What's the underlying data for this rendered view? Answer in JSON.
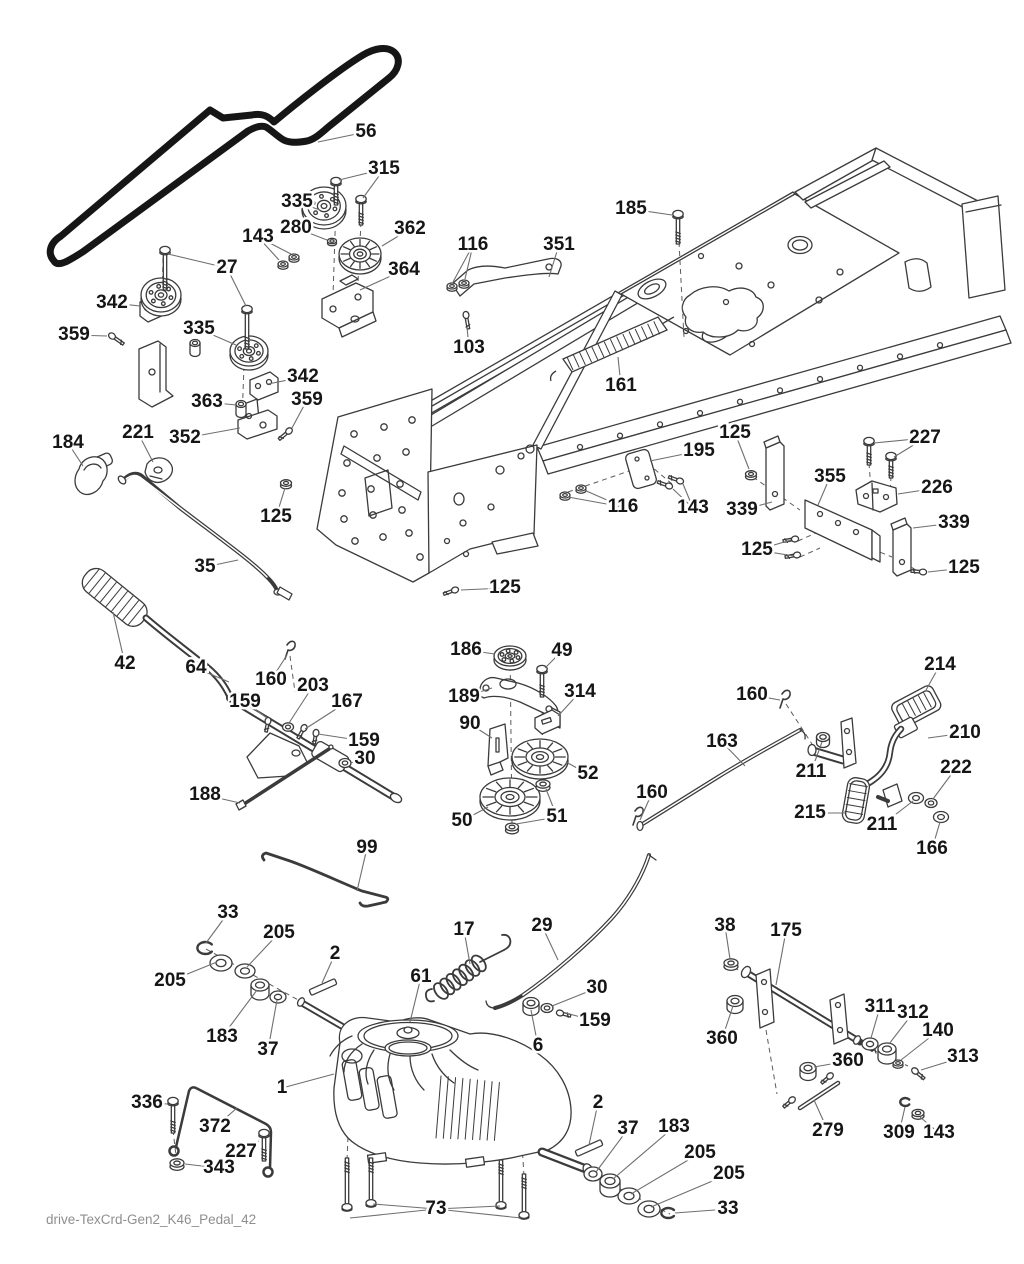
{
  "footer": "drive-TexCrd-Gen2_K46_Pedal_42",
  "colors": {
    "line": "#3b3b3b",
    "belt": "#161616",
    "leader": "#6f6f6f",
    "label_text": "#161616",
    "footer_text": "#8f8f8f",
    "background": "#ffffff"
  },
  "diagram": {
    "type": "exploded-parts-diagram",
    "labels": [
      {
        "text": "56",
        "x": 366,
        "y": 132,
        "leaders": [
          [
            318,
            142
          ]
        ]
      },
      {
        "text": "315",
        "x": 384,
        "y": 169,
        "leaders": [
          [
            339,
            180
          ],
          [
            363,
            198
          ]
        ]
      },
      {
        "text": "335",
        "x": 297,
        "y": 202,
        "leaders": [
          [
            320,
            210
          ]
        ]
      },
      {
        "text": "280",
        "x": 296,
        "y": 228,
        "leaders": [
          [
            327,
            240
          ]
        ]
      },
      {
        "text": "362",
        "x": 410,
        "y": 229,
        "leaders": [
          [
            382,
            246
          ]
        ]
      },
      {
        "text": "143",
        "x": 258,
        "y": 237,
        "leaders": [
          [
            279,
            260
          ],
          [
            291,
            254
          ]
        ]
      },
      {
        "text": "364",
        "x": 404,
        "y": 270,
        "leaders": [
          [
            360,
            290
          ]
        ]
      },
      {
        "text": "27",
        "x": 227,
        "y": 268,
        "leaders": [
          [
            168,
            254
          ],
          [
            246,
            306
          ]
        ]
      },
      {
        "text": "342",
        "x": 112,
        "y": 303,
        "leaders": [
          [
            140,
            306
          ]
        ]
      },
      {
        "text": "335",
        "x": 199,
        "y": 329,
        "leaders": [
          [
            236,
            345
          ]
        ]
      },
      {
        "text": "359",
        "x": 74,
        "y": 335,
        "leaders": [
          [
            107,
            336
          ]
        ]
      },
      {
        "text": "116",
        "x": 473,
        "y": 245,
        "leaders": [
          [
            453,
            282
          ],
          [
            465,
            279
          ]
        ]
      },
      {
        "text": "103",
        "x": 469,
        "y": 348,
        "leaders": [
          [
            467,
            327
          ]
        ]
      },
      {
        "text": "342",
        "x": 303,
        "y": 377,
        "leaders": [
          [
            268,
            384
          ]
        ]
      },
      {
        "text": "363",
        "x": 207,
        "y": 402,
        "leaders": [
          [
            236,
            405
          ]
        ]
      },
      {
        "text": "359",
        "x": 307,
        "y": 400,
        "leaders": [
          [
            292,
            428
          ]
        ]
      },
      {
        "text": "352",
        "x": 185,
        "y": 438,
        "leaders": [
          [
            240,
            428
          ]
        ]
      },
      {
        "text": "184",
        "x": 68,
        "y": 443,
        "leaders": [
          [
            83,
            466
          ]
        ]
      },
      {
        "text": "221",
        "x": 138,
        "y": 433,
        "leaders": [
          [
            153,
            462
          ]
        ]
      },
      {
        "text": "125",
        "x": 276,
        "y": 517,
        "leaders": [
          [
            285,
            488
          ]
        ]
      },
      {
        "text": "35",
        "x": 205,
        "y": 567,
        "leaders": [
          [
            238,
            560
          ]
        ]
      },
      {
        "text": "42",
        "x": 125,
        "y": 664,
        "leaders": [
          [
            113,
            612
          ]
        ]
      },
      {
        "text": "64",
        "x": 196,
        "y": 668,
        "leaders": [
          [
            229,
            682
          ]
        ]
      },
      {
        "text": "160",
        "x": 271,
        "y": 680,
        "leaders": [
          [
            287,
            655
          ]
        ]
      },
      {
        "text": "203",
        "x": 313,
        "y": 686,
        "leaders": [
          [
            289,
            723
          ]
        ]
      },
      {
        "text": "167",
        "x": 347,
        "y": 702,
        "leaders": [
          [
            305,
            729
          ]
        ]
      },
      {
        "text": "159",
        "x": 245,
        "y": 702,
        "leaders": [
          [
            267,
            718
          ]
        ]
      },
      {
        "text": "159",
        "x": 364,
        "y": 741,
        "leaders": [
          [
            318,
            734
          ]
        ]
      },
      {
        "text": "30",
        "x": 365,
        "y": 759,
        "leaders": [
          [
            350,
            763
          ]
        ]
      },
      {
        "text": "188",
        "x": 205,
        "y": 795,
        "leaders": [
          [
            240,
            803
          ]
        ]
      },
      {
        "text": "186",
        "x": 466,
        "y": 650,
        "leaders": [
          [
            495,
            654
          ]
        ]
      },
      {
        "text": "49",
        "x": 562,
        "y": 651,
        "leaders": [
          [
            545,
            668
          ]
        ]
      },
      {
        "text": "189",
        "x": 464,
        "y": 697,
        "leaders": [
          [
            492,
            688
          ]
        ]
      },
      {
        "text": "314",
        "x": 580,
        "y": 692,
        "leaders": [
          [
            558,
            716
          ]
        ]
      },
      {
        "text": "90",
        "x": 470,
        "y": 724,
        "leaders": [
          [
            492,
            738
          ]
        ]
      },
      {
        "text": "52",
        "x": 588,
        "y": 774,
        "leaders": [
          [
            566,
            762
          ]
        ]
      },
      {
        "text": "50",
        "x": 462,
        "y": 821,
        "leaders": [
          [
            488,
            807
          ]
        ]
      },
      {
        "text": "51",
        "x": 557,
        "y": 817,
        "leaders": [
          [
            546,
            789
          ],
          [
            516,
            824
          ]
        ]
      },
      {
        "text": "160",
        "x": 652,
        "y": 793,
        "leaders": [
          [
            640,
            820
          ]
        ]
      },
      {
        "text": "163",
        "x": 722,
        "y": 742,
        "leaders": [
          [
            745,
            766
          ]
        ]
      },
      {
        "text": "214",
        "x": 940,
        "y": 665,
        "leaders": [
          [
            926,
            690
          ]
        ]
      },
      {
        "text": "210",
        "x": 965,
        "y": 733,
        "leaders": [
          [
            928,
            738
          ]
        ]
      },
      {
        "text": "160",
        "x": 752,
        "y": 695,
        "leaders": [
          [
            780,
            700
          ]
        ]
      },
      {
        "text": "211",
        "x": 811,
        "y": 772,
        "leaders": [
          [
            822,
            742
          ]
        ]
      },
      {
        "text": "222",
        "x": 956,
        "y": 768,
        "leaders": [
          [
            933,
            799
          ]
        ]
      },
      {
        "text": "215",
        "x": 810,
        "y": 813,
        "leaders": [
          [
            845,
            813
          ]
        ]
      },
      {
        "text": "211",
        "x": 882,
        "y": 825,
        "leaders": [
          [
            913,
            801
          ]
        ]
      },
      {
        "text": "166",
        "x": 932,
        "y": 849,
        "leaders": [
          [
            940,
            822
          ]
        ]
      },
      {
        "text": "99",
        "x": 367,
        "y": 848,
        "leaders": [
          [
            357,
            891
          ]
        ]
      },
      {
        "text": "33",
        "x": 228,
        "y": 913,
        "leaders": [
          [
            206,
            943
          ]
        ]
      },
      {
        "text": "205",
        "x": 279,
        "y": 933,
        "leaders": [
          [
            247,
            967
          ]
        ]
      },
      {
        "text": "205",
        "x": 170,
        "y": 981,
        "leaders": [
          [
            217,
            962
          ]
        ]
      },
      {
        "text": "2",
        "x": 335,
        "y": 954,
        "leaders": [
          [
            322,
            983
          ]
        ]
      },
      {
        "text": "61",
        "x": 421,
        "y": 977,
        "leaders": [
          [
            410,
            1022
          ]
        ]
      },
      {
        "text": "17",
        "x": 464,
        "y": 930,
        "leaders": [
          [
            470,
            964
          ]
        ]
      },
      {
        "text": "29",
        "x": 542,
        "y": 926,
        "leaders": [
          [
            558,
            960
          ]
        ]
      },
      {
        "text": "183",
        "x": 222,
        "y": 1037,
        "leaders": [
          [
            257,
            990
          ]
        ]
      },
      {
        "text": "37",
        "x": 268,
        "y": 1050,
        "leaders": [
          [
            277,
            1000
          ]
        ]
      },
      {
        "text": "1",
        "x": 282,
        "y": 1088,
        "leaders": [
          [
            334,
            1074
          ]
        ]
      },
      {
        "text": "336",
        "x": 147,
        "y": 1103,
        "leaders": [
          [
            168,
            1104
          ]
        ]
      },
      {
        "text": "372",
        "x": 215,
        "y": 1127,
        "leaders": [
          [
            237,
            1108
          ]
        ]
      },
      {
        "text": "227",
        "x": 241,
        "y": 1152,
        "leaders": [
          [
            259,
            1141
          ]
        ]
      },
      {
        "text": "343",
        "x": 219,
        "y": 1168,
        "leaders": [
          [
            185,
            1164
          ]
        ]
      },
      {
        "text": "38",
        "x": 725,
        "y": 926,
        "leaders": [
          [
            730,
            959
          ]
        ]
      },
      {
        "text": "175",
        "x": 786,
        "y": 931,
        "leaders": [
          [
            776,
            985
          ]
        ]
      },
      {
        "text": "360",
        "x": 722,
        "y": 1039,
        "leaders": [
          [
            733,
            1006
          ]
        ]
      },
      {
        "text": "311",
        "x": 880,
        "y": 1007,
        "leaders": [
          [
            871,
            1038
          ]
        ]
      },
      {
        "text": "312",
        "x": 913,
        "y": 1013,
        "leaders": [
          [
            889,
            1044
          ]
        ]
      },
      {
        "text": "140",
        "x": 938,
        "y": 1031,
        "leaders": [
          [
            901,
            1060
          ]
        ]
      },
      {
        "text": "313",
        "x": 963,
        "y": 1057,
        "leaders": [
          [
            921,
            1070
          ]
        ]
      },
      {
        "text": "360",
        "x": 848,
        "y": 1061,
        "leaders": [
          [
            814,
            1067
          ]
        ]
      },
      {
        "text": "279",
        "x": 828,
        "y": 1131,
        "leaders": [
          [
            814,
            1100
          ]
        ]
      },
      {
        "text": "309",
        "x": 899,
        "y": 1133,
        "leaders": [
          [
            905,
            1107
          ]
        ]
      },
      {
        "text": "143",
        "x": 939,
        "y": 1133,
        "leaders": [
          [
            920,
            1117
          ]
        ]
      },
      {
        "text": "6",
        "x": 538,
        "y": 1046,
        "leaders": [
          [
            531,
            1010
          ]
        ]
      },
      {
        "text": "30",
        "x": 597,
        "y": 988,
        "leaders": [
          [
            552,
            1006
          ]
        ]
      },
      {
        "text": "159",
        "x": 595,
        "y": 1021,
        "leaders": [
          [
            566,
            1013
          ]
        ]
      },
      {
        "text": "2",
        "x": 598,
        "y": 1103,
        "leaders": [
          [
            589,
            1145
          ]
        ]
      },
      {
        "text": "37",
        "x": 628,
        "y": 1129,
        "leaders": [
          [
            596,
            1172
          ]
        ]
      },
      {
        "text": "183",
        "x": 674,
        "y": 1127,
        "leaders": [
          [
            613,
            1179
          ]
        ]
      },
      {
        "text": "205",
        "x": 700,
        "y": 1153,
        "leaders": [
          [
            631,
            1194
          ]
        ]
      },
      {
        "text": "205",
        "x": 729,
        "y": 1174,
        "leaders": [
          [
            651,
            1207
          ]
        ]
      },
      {
        "text": "33",
        "x": 728,
        "y": 1209,
        "leaders": [
          [
            675,
            1213
          ]
        ]
      },
      {
        "text": "73",
        "x": 436,
        "y": 1209,
        "leaders": [
          [
            350,
            1218
          ],
          [
            373,
            1204
          ],
          [
            500,
            1206
          ],
          [
            521,
            1218
          ]
        ]
      },
      {
        "text": "185",
        "x": 631,
        "y": 209,
        "leaders": [
          [
            672,
            215
          ]
        ]
      },
      {
        "text": "351",
        "x": 559,
        "y": 245,
        "leaders": [
          [
            549,
            277
          ]
        ]
      },
      {
        "text": "161",
        "x": 621,
        "y": 386,
        "leaders": [
          [
            618,
            357
          ]
        ]
      },
      {
        "text": "125",
        "x": 735,
        "y": 433,
        "leaders": [
          [
            749,
            469
          ]
        ]
      },
      {
        "text": "195",
        "x": 699,
        "y": 451,
        "leaders": [
          [
            650,
            461
          ]
        ]
      },
      {
        "text": "116",
        "x": 623,
        "y": 507,
        "leaders": [
          [
            584,
            490
          ],
          [
            568,
            497
          ]
        ]
      },
      {
        "text": "143",
        "x": 693,
        "y": 508,
        "leaders": [
          [
            673,
            489
          ],
          [
            683,
            484
          ]
        ]
      },
      {
        "text": "339",
        "x": 742,
        "y": 510,
        "leaders": [
          [
            772,
            502
          ]
        ]
      },
      {
        "text": "355",
        "x": 830,
        "y": 477,
        "leaders": [
          [
            818,
            505
          ]
        ]
      },
      {
        "text": "227",
        "x": 925,
        "y": 438,
        "leaders": [
          [
            874,
            443
          ],
          [
            894,
            457
          ]
        ]
      },
      {
        "text": "226",
        "x": 937,
        "y": 488,
        "leaders": [
          [
            898,
            494
          ]
        ]
      },
      {
        "text": "339",
        "x": 954,
        "y": 523,
        "leaders": [
          [
            913,
            528
          ]
        ]
      },
      {
        "text": "125",
        "x": 757,
        "y": 550,
        "leaders": [
          [
            791,
            540
          ],
          [
            794,
            556
          ]
        ]
      },
      {
        "text": "125",
        "x": 964,
        "y": 568,
        "leaders": [
          [
            928,
            572
          ]
        ]
      },
      {
        "text": "125",
        "x": 505,
        "y": 588,
        "leaders": [
          [
            461,
            590
          ]
        ]
      }
    ]
  }
}
